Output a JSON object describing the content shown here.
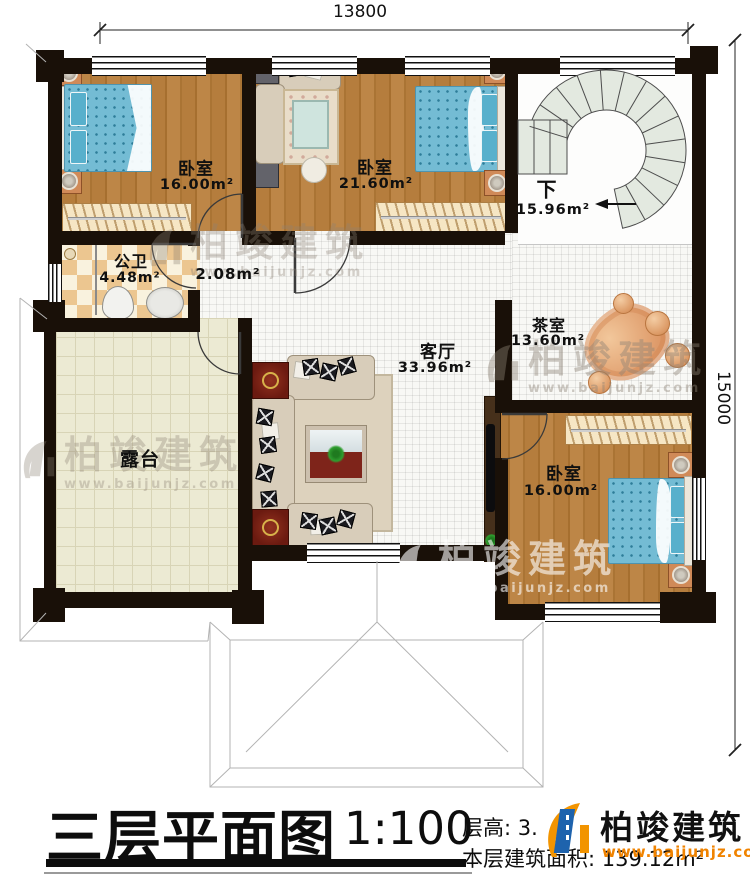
{
  "dimensions": {
    "width_mm": "13800",
    "height_mm": "15000"
  },
  "rooms": {
    "bedroom_top_left": {
      "name": "卧室",
      "area": "16.00m²"
    },
    "bedroom_top_mid": {
      "name": "卧室",
      "area": "21.60m²"
    },
    "bedroom_bottom_right": {
      "name": "卧室",
      "area": "16.00m²"
    },
    "bathroom": {
      "name": "公卫",
      "area": "4.48m²"
    },
    "hallway": {
      "area": "2.08m²"
    },
    "living_room": {
      "name": "客厅",
      "area": "33.96m²"
    },
    "tea_room": {
      "name": "茶室",
      "area": "13.60m²"
    },
    "stairs": {
      "name": "下",
      "area": "15.96m²"
    },
    "terrace": {
      "name": "露台"
    }
  },
  "title_block": {
    "title": "三层平面图",
    "scale": "1:100",
    "floor_height": "层高: 3.",
    "floor_area": "本层建筑面积: 139.12m²"
  },
  "brand": {
    "name": "柏竣建筑",
    "site": "www.baijunjz.com"
  },
  "colors": {
    "wall": "#191008",
    "wood_floor": "#b57d3d",
    "terrace_floor": "#ecead3",
    "bath_tile": "#ecc690",
    "stair_tread": "#e3e9e0",
    "bed": "#74bcd4",
    "brand_blue": "#1e63ad",
    "brand_orange": "#f29400"
  }
}
